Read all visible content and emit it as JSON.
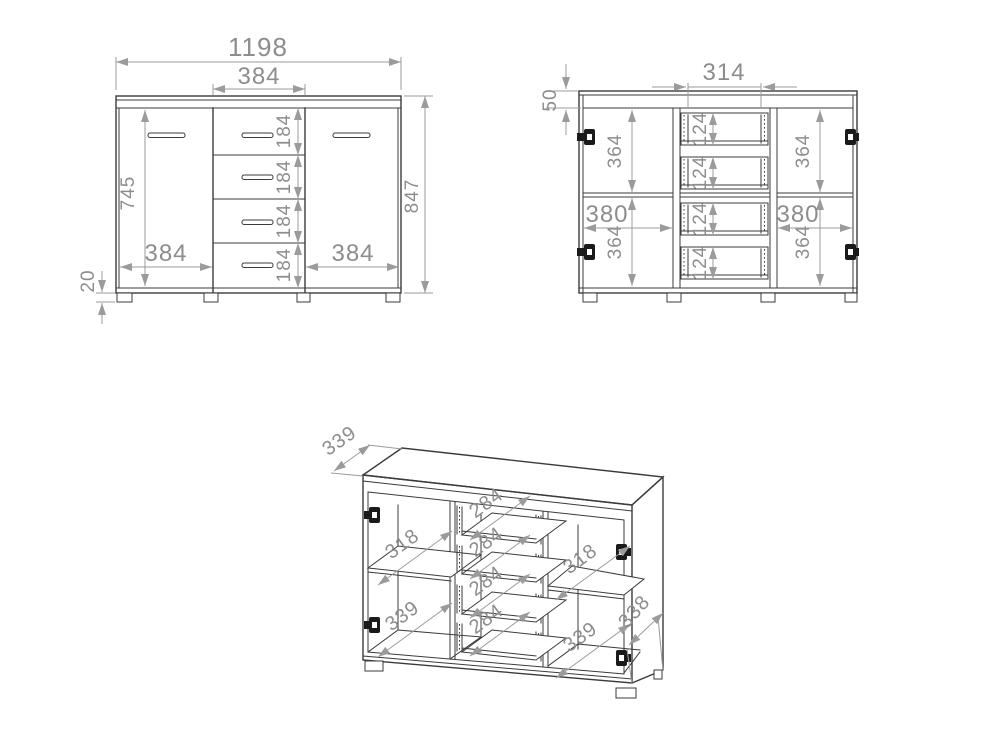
{
  "drawing": {
    "title": "sideboard-dimension-drawing",
    "colors": {
      "line": "#3b3b3b",
      "dimension": "#9b9b9b",
      "text": "#8d8d8d",
      "background": "#ffffff"
    }
  },
  "views": {
    "front": {
      "overall_width": "1198",
      "drawer_col_width": "384",
      "drawer_heights": [
        "184",
        "184",
        "184",
        "184"
      ],
      "door_height": "745",
      "overall_height": "847",
      "left_door_width": "384",
      "right_door_width": "384",
      "plinth_height": "20"
    },
    "internal": {
      "drawer_opening_width": "314",
      "top_clearance": "50",
      "upper_compartment_heights": [
        "364",
        "364"
      ],
      "lower_compartment_heights": [
        "364",
        "364"
      ],
      "compartment_widths": [
        "380",
        "380"
      ],
      "drawer_box_heights": [
        "124",
        "124",
        "124",
        "124"
      ]
    },
    "iso": {
      "top_depth": "339",
      "shelf_depths": [
        "318",
        "318"
      ],
      "drawer_depths": [
        "284",
        "284",
        "284",
        "284"
      ],
      "compartment_depths": [
        "339",
        "339"
      ],
      "side_depth": "338"
    }
  }
}
